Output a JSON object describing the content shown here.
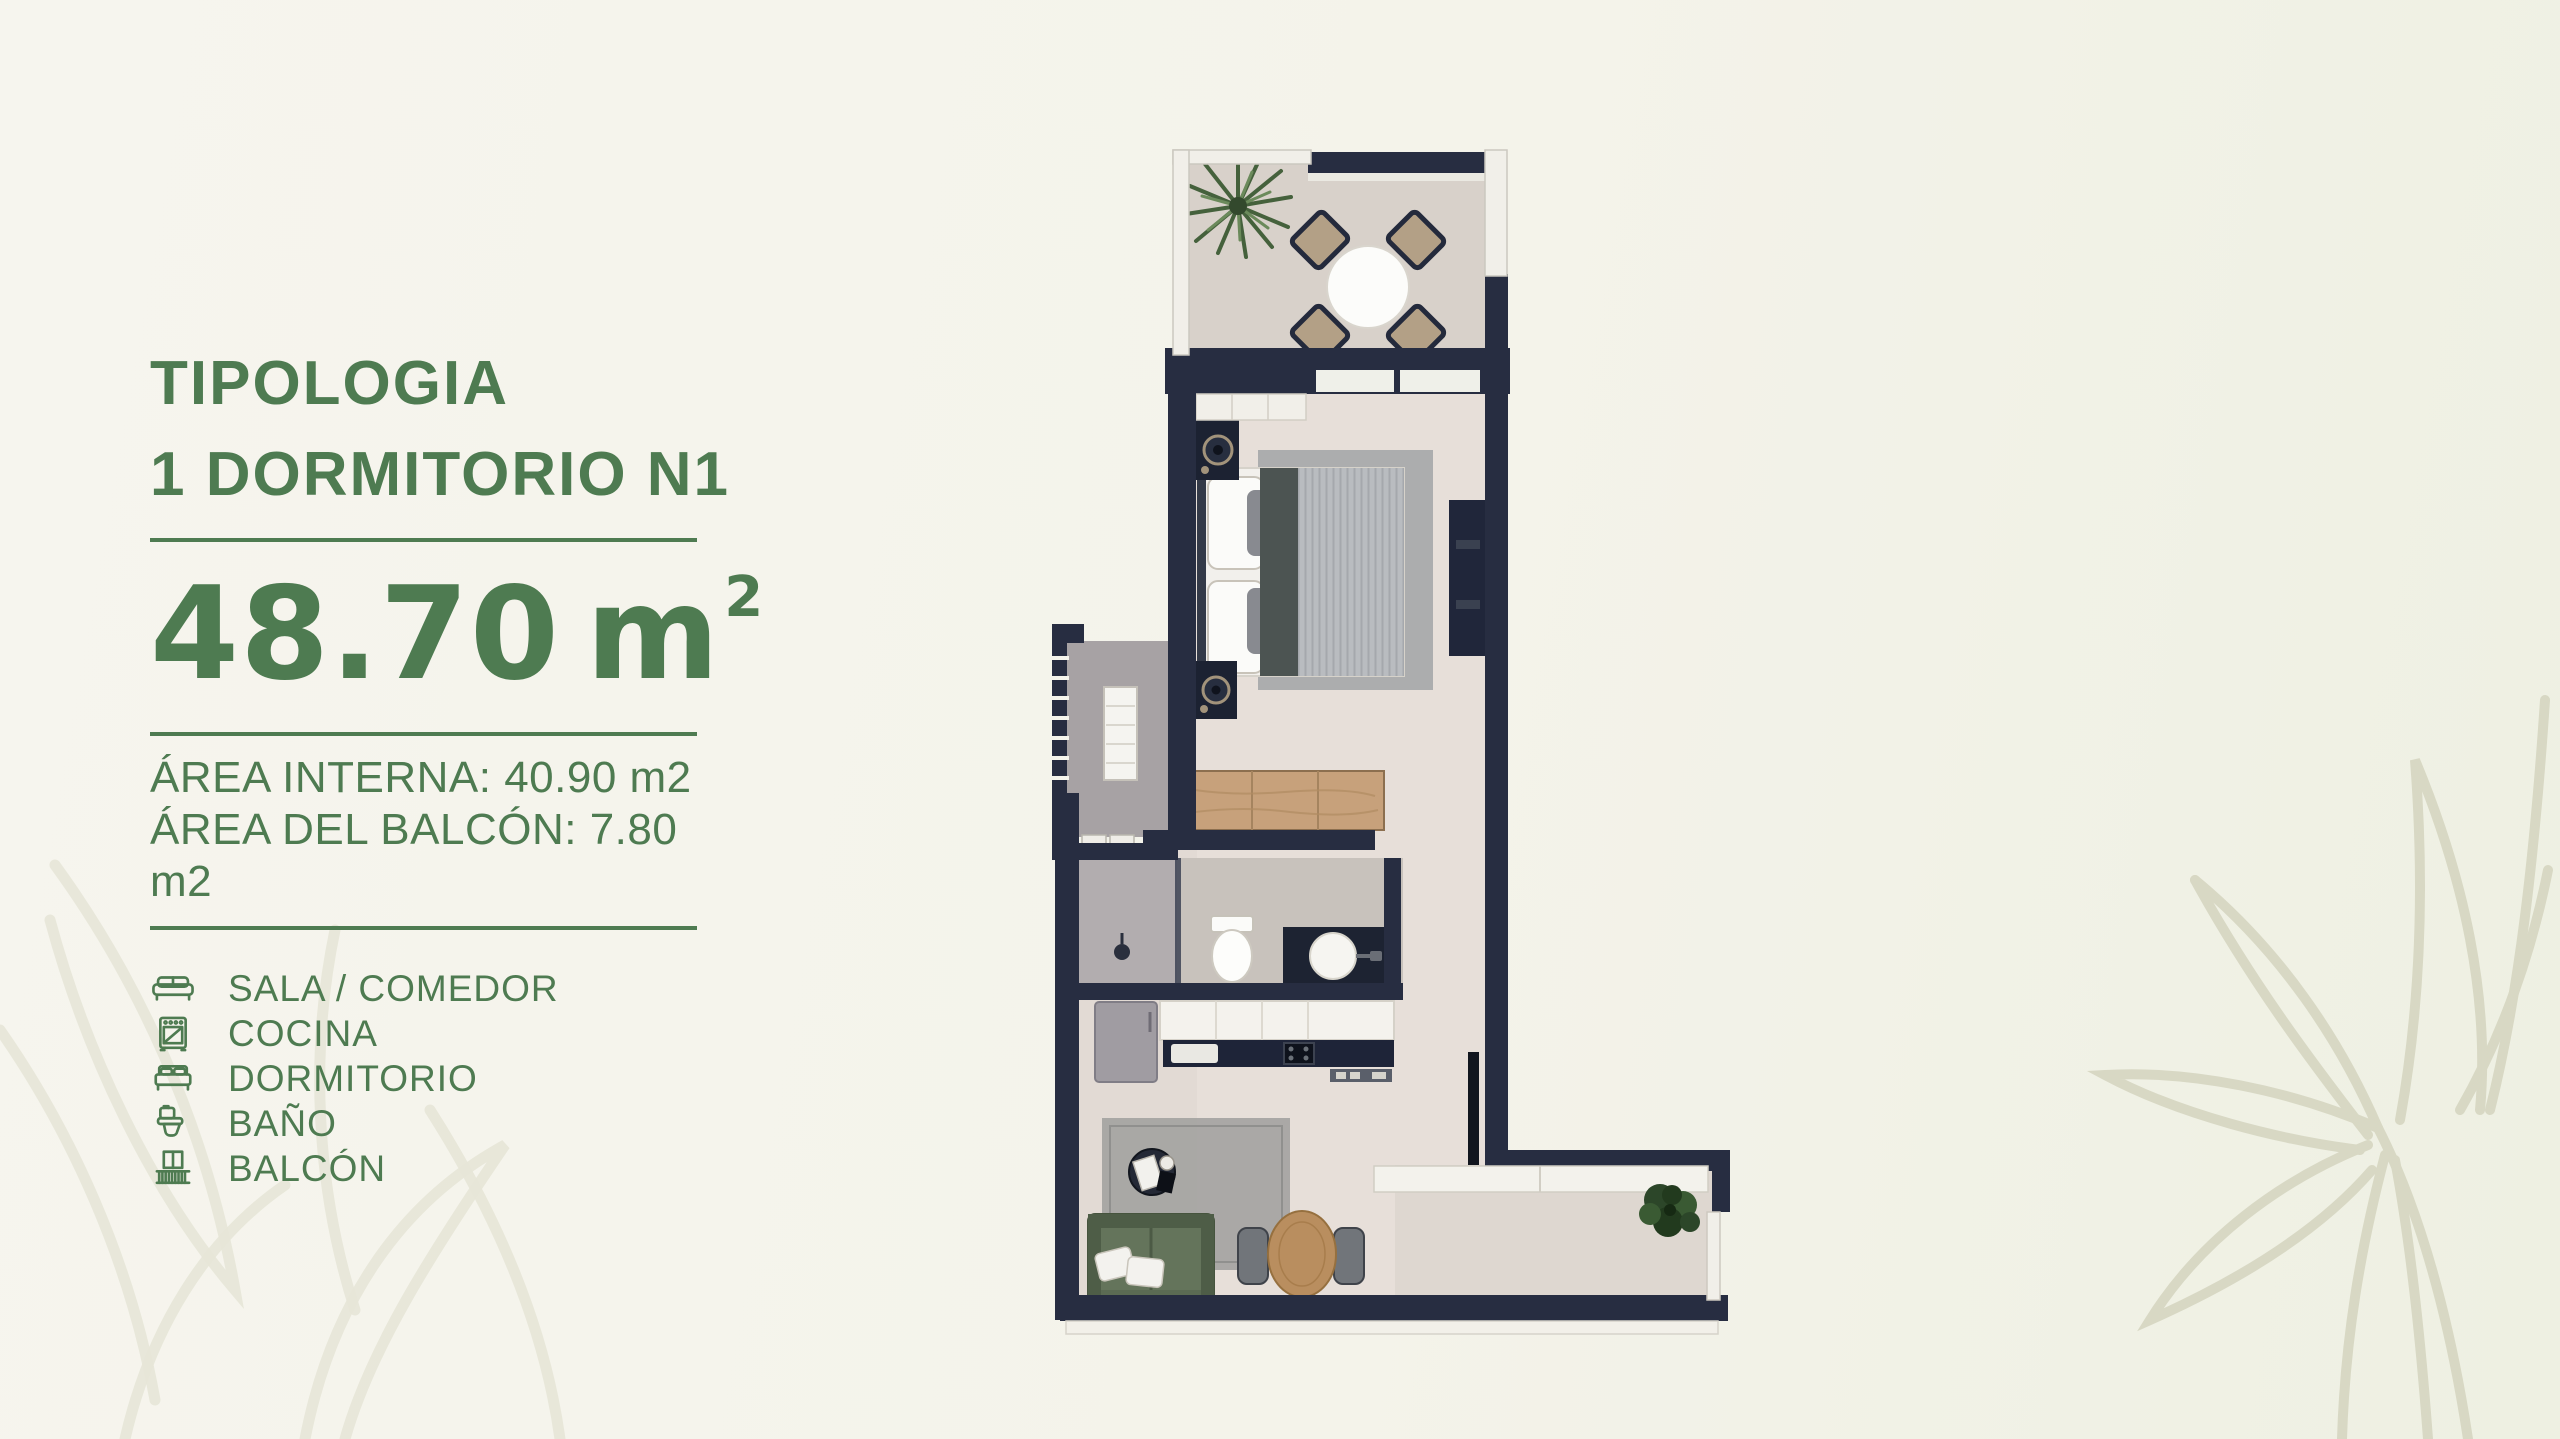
{
  "panel": {
    "accent_color": "#4e7b51",
    "title_line1": "TIPOLOGIA",
    "title_line2": "1 DORMITORIO N1",
    "area": {
      "value": "48.70",
      "unit": "m",
      "exponent": "2"
    },
    "details": [
      "ÁREA INTERNA: 40.90 m2",
      "ÁREA DEL BALCÓN: 7.80 m2"
    ],
    "legend": [
      {
        "icon": "sofa-icon",
        "label": "SALA / COMEDOR"
      },
      {
        "icon": "stove-icon",
        "label": "COCINA"
      },
      {
        "icon": "bed-icon",
        "label": "DORMITORIO"
      },
      {
        "icon": "toilet-icon",
        "label": "BAÑO"
      },
      {
        "icon": "balcony-icon",
        "label": "BALCÓN"
      }
    ]
  },
  "floorplan": {
    "wall_color": "#272d41",
    "floor_colors": {
      "terrace": "#d8d1ca",
      "interior": "#e7dfd9",
      "bathroom": "#c8c2bc",
      "shower": "#b2adaf",
      "service_balcony": "#a7a2a4",
      "balcony": "#ded7d0"
    },
    "furniture_colors": {
      "sofa_green": "#5b6b53",
      "dresser_wood": "#c7a17b",
      "dining_table_wood": "#b98e5f",
      "plant_green": "#3a5a33"
    }
  },
  "background": {
    "left": "#f6f5ee",
    "right": "#eef0e2",
    "leaf_line_right": "#d8d8c4",
    "leaf_line_left": "#e7e5d7"
  }
}
